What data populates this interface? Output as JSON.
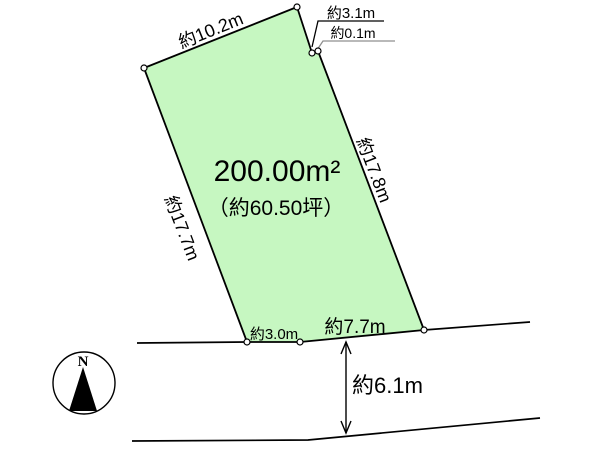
{
  "diagram": {
    "type": "land-plot-survey-diagram",
    "plot": {
      "area_label": "200.00m²",
      "area_tsubo_label": "（約60.50坪）",
      "fill_color": "#c6f7c1",
      "line_color": "#000000"
    },
    "dimensions": {
      "top_edge": "約10.2m",
      "upper_right_edge": "約3.1m",
      "upper_right_offset": "約0.1m",
      "right_edge": "約17.8m",
      "left_edge": "約17.7m",
      "bottom_left_edge": "約3.0m",
      "bottom_right_edge": "約7.7m",
      "road_width": "約6.1m"
    },
    "compass": {
      "north_label": "N"
    },
    "colors": {
      "leader_gray": "#8f8f8f",
      "stroke_black": "#000000"
    }
  }
}
